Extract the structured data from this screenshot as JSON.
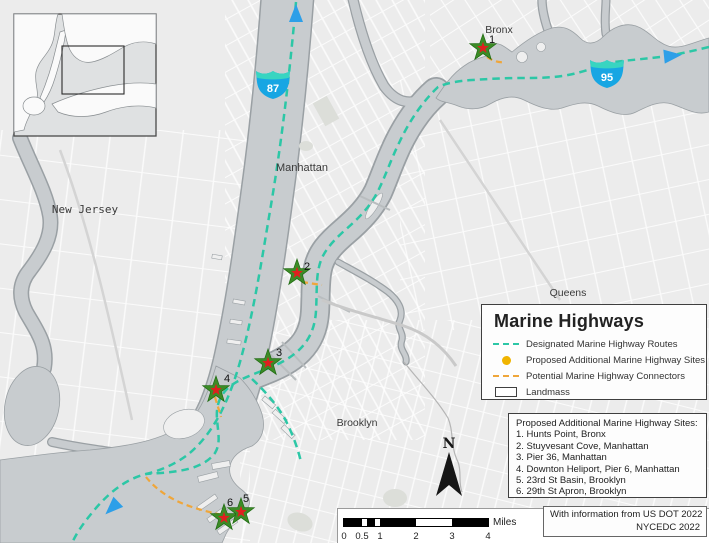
{
  "map": {
    "place_labels": {
      "bronx": "Bronx",
      "manhattan": "Manhattan",
      "new_jersey": "New Jersey",
      "queens": "Queens",
      "brooklyn": "Brooklyn"
    },
    "shields": [
      {
        "number": "87"
      },
      {
        "number": "95"
      }
    ],
    "site_numbers": [
      "1",
      "2",
      "3",
      "4",
      "5",
      "6"
    ],
    "north_label": "N"
  },
  "legend": {
    "title": "Marine Highways",
    "items": [
      {
        "swatch": "teal-dashed-line",
        "label": "Designated Marine Highway Routes"
      },
      {
        "swatch": "yellow-dot",
        "label": "Proposed Additional Marine Highway Sites"
      },
      {
        "swatch": "orange-dashed-line",
        "label": "Potential Marine Highway Connectors"
      },
      {
        "swatch": "landmass-box",
        "label": "Landmass"
      }
    ]
  },
  "sites_list": {
    "title": "Proposed Additional Marine Highway Sites:",
    "items": [
      "1. Hunts Point, Bronx",
      "2. Stuyvesant Cove, Manhattan",
      "3. Pier 36, Manhattan",
      "4. Downton Heliport, Pier 6, Manhattan",
      "5. 23rd St Basin, Brooklyn",
      "6. 29th St Apron, Brooklyn"
    ]
  },
  "scale_bar": {
    "tick_labels": [
      "0",
      "0.5",
      "1",
      "2",
      "3",
      "4"
    ],
    "unit": "Miles"
  },
  "attribution": {
    "line1": "With information from US DOT 2022",
    "line2": "NYCEDC 2022"
  },
  "colors": {
    "route_teal": "#2cc7a6",
    "connector_orange": "#efa63a",
    "site_yellow": "#f0b400",
    "star_green": "#3c8b26",
    "star_red": "#e01f1f",
    "arrow_blue": "#2d9fe8",
    "shield_blue": "#17a6e3",
    "shield_crest": "#38d5c1",
    "water_gray": "#c8cccf",
    "land_gray": "#ececec"
  }
}
